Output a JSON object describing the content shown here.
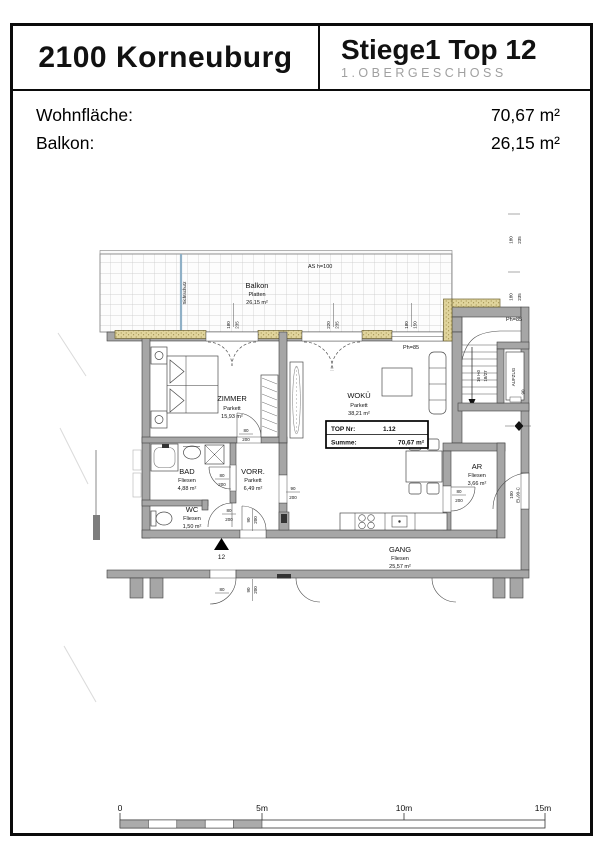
{
  "header": {
    "location": "2100 Korneuburg",
    "unit": "Stiege1 Top 12",
    "floor": "1.OBERGESCHOSS"
  },
  "summary": {
    "rows": [
      {
        "label": "Wohnfläche:",
        "value": "70,67 m²"
      },
      {
        "label": "Balkon:",
        "value": "26,15 m²"
      }
    ]
  },
  "plan": {
    "balcony": {
      "name": "Balkon",
      "finish": "Platten",
      "area": "26,15 m²",
      "privacy_screen": "Sichtschutz",
      "railing_note": "AS h=100"
    },
    "rooms": [
      {
        "name": "ZIMMER",
        "finish": "Parkett",
        "area": "15,93 m²"
      },
      {
        "name": "WOKÜ",
        "finish": "Parkett",
        "area": "38,21 m²"
      },
      {
        "name": "BAD",
        "finish": "Fliesen",
        "area": "4,88 m²"
      },
      {
        "name": "VORR.",
        "finish": "Parkett",
        "area": "6,49 m²"
      },
      {
        "name": "WC",
        "finish": "Fliesen",
        "area": "1,50 m²"
      },
      {
        "name": "AR",
        "finish": "Fliesen",
        "area": "3,66 m²"
      },
      {
        "name": "GANG",
        "finish": "Fliesen",
        "area": "25,57 m²"
      }
    ],
    "top_box": {
      "label1": "TOP Nr:",
      "value1": "1.12",
      "label2": "Summe:",
      "value2": "70,67 m²"
    },
    "stairwell": {
      "elevator": "AUFZUG",
      "stair_note_line1": "16 Hö",
      "stair_note_line2": "18/27",
      "elevator_door_width": "90"
    },
    "entrance": {
      "unit_number": "12"
    },
    "parapets": {
      "p1": "Ph=85",
      "p2": "Ph=85"
    },
    "fire_door": {
      "width": "100",
      "rating": "EI₂90-C"
    },
    "window_dims": [
      {
        "w": "180",
        "h": "235"
      },
      {
        "w": "220",
        "h": "235"
      },
      {
        "w": "180",
        "h": "150"
      },
      {
        "w": "180",
        "h": "235"
      },
      {
        "w": "180",
        "h": "235"
      }
    ],
    "door_dims": [
      {
        "w": "80",
        "h": "200"
      },
      {
        "w": "80",
        "h": "200"
      },
      {
        "w": "80",
        "h": "200"
      },
      {
        "w": "90",
        "h": "200"
      },
      {
        "w": "90",
        "h": "200"
      },
      {
        "w": "80",
        "h": "200"
      }
    ],
    "corridor_dims": {
      "door1_w": "80",
      "door2_w": "90",
      "door2_h": "200"
    }
  },
  "scale_bar": {
    "t0": "0",
    "t5": "5m",
    "t10": "10m",
    "t15": "15m"
  },
  "colors": {
    "wall": "#a6a6a6",
    "sill": "#e0d49c",
    "glass_screen": "#8fb0c6"
  }
}
